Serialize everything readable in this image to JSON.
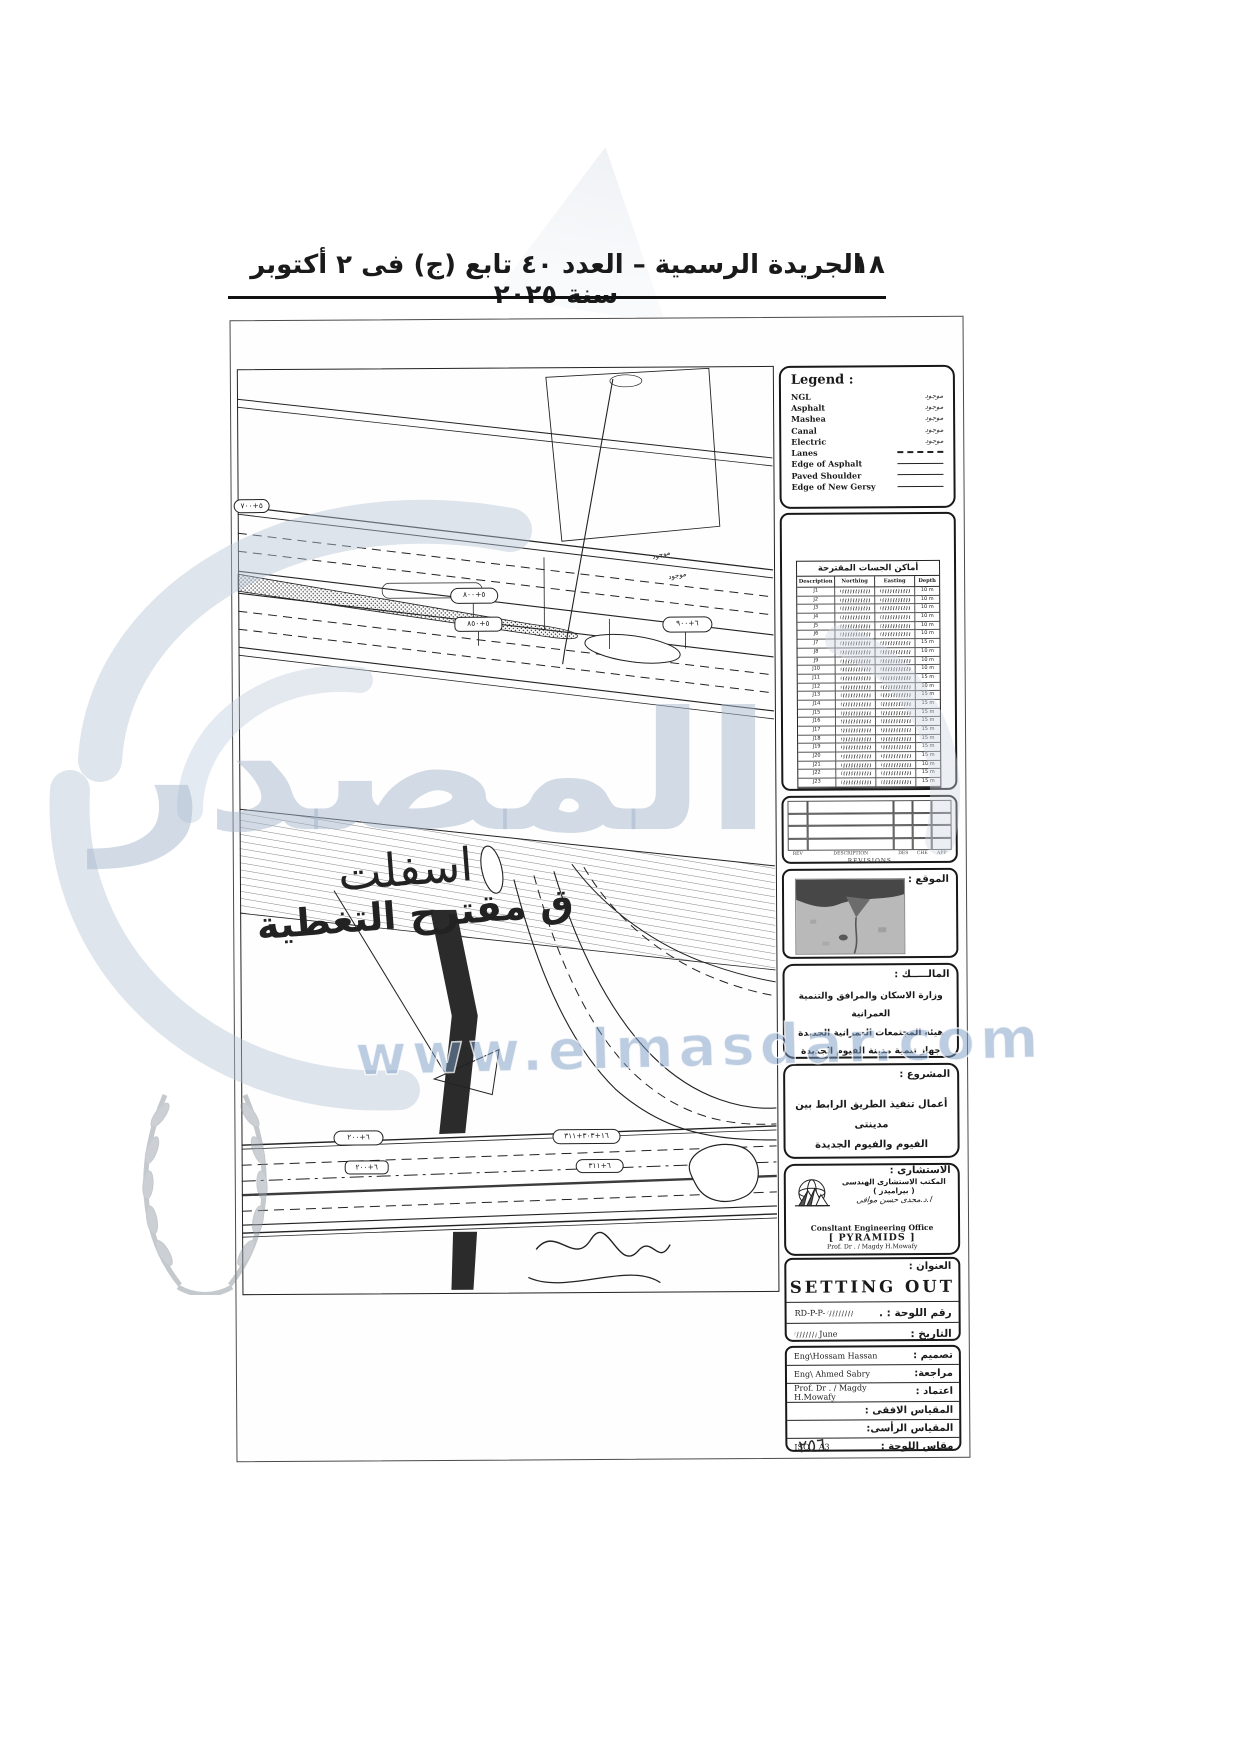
{
  "header": {
    "page_number": "١٨",
    "title": "الجريدة الرسمية – العدد ٤٠ تابع (ج) فى ٢ أكتوبر سنة ٢٠٢٥"
  },
  "legend": {
    "title": "Legend :",
    "items": [
      {
        "label": "NGL",
        "symbol": "scribble",
        "note": "موجود"
      },
      {
        "label": "Asphalt",
        "symbol": "scribble",
        "note": "موجود"
      },
      {
        "label": "Mashea",
        "symbol": "scribble",
        "note": "موجود"
      },
      {
        "label": "Canal",
        "symbol": "scribble",
        "note": "موجود"
      },
      {
        "label": "Electric",
        "symbol": "scribble",
        "note": "موجود"
      },
      {
        "label": "Lanes",
        "symbol": "dashed",
        "note": ""
      },
      {
        "label": "Edge of Asphalt",
        "symbol": "solid",
        "note": ""
      },
      {
        "label": "Paved Shoulder",
        "symbol": "solid",
        "note": ""
      },
      {
        "label": "Edge of New Gersy",
        "symbol": "solid",
        "note": ""
      }
    ]
  },
  "borings_table": {
    "title": "أماكن الجسات المقترحة",
    "columns": [
      "Description",
      "Northing",
      "Easting",
      "Depth"
    ],
    "rows": [
      {
        "n": "J1",
        "d": "10 m"
      },
      {
        "n": "J2",
        "d": "10 m"
      },
      {
        "n": "J3",
        "d": "10 m"
      },
      {
        "n": "J4",
        "d": "10 m"
      },
      {
        "n": "J5",
        "d": "10 m"
      },
      {
        "n": "J6",
        "d": "10 m"
      },
      {
        "n": "J7",
        "d": "15 m"
      },
      {
        "n": "J8",
        "d": "10 m"
      },
      {
        "n": "J9",
        "d": "10 m"
      },
      {
        "n": "J10",
        "d": "10 m"
      },
      {
        "n": "J11",
        "d": "15 m"
      },
      {
        "n": "J12",
        "d": "10 m"
      },
      {
        "n": "J13",
        "d": "15 m"
      },
      {
        "n": "J14",
        "d": "15 m"
      },
      {
        "n": "J15",
        "d": "15 m"
      },
      {
        "n": "J16",
        "d": "15 m"
      },
      {
        "n": "J17",
        "d": "15 m"
      },
      {
        "n": "J18",
        "d": "15 m"
      },
      {
        "n": "J19",
        "d": "15 m"
      },
      {
        "n": "J20",
        "d": "15 m"
      },
      {
        "n": "J21",
        "d": "10 m"
      },
      {
        "n": "J22",
        "d": "15 m"
      },
      {
        "n": "J23",
        "d": "15 m"
      }
    ]
  },
  "revisions": {
    "columns": [
      "REV",
      "DESCRIPTION",
      "DES",
      "CHE",
      "APP"
    ],
    "caption": "REVISIONS"
  },
  "location": {
    "label": "الموقع :"
  },
  "owner": {
    "label": "المالـــــك :",
    "lines": [
      "وزارة الاسكان والمرافق والتنمية العمرانية",
      "هيئة المجتمعات العمرانية الجديدة",
      "جهاز تنمية مدينة الفيوم الجديدة"
    ]
  },
  "project": {
    "label": "المشروع :",
    "lines": [
      "أعمال تنفيذ الطريق الرابط بين مدينتى",
      "الفيوم والفيوم الجديدة"
    ]
  },
  "consultant": {
    "label": "الاستشارى :",
    "office_ar": "المكتب الاستشارى الهندسى",
    "office_ar2": "( بيراميدز )",
    "principal_ar": "ا.د.مجدى حسن موافى",
    "office_en": "Consltant Engineering Office",
    "office_en2": "[ PYRAMIDS ]",
    "principal_en": "Prof. Dr . / Magdy H.Mowafy"
  },
  "title_block": {
    "label": "العنوان :",
    "title": "SETTING  OUT",
    "drawing_no_label": "رقم اللوحة : .",
    "drawing_no_value": "RD-P-P-",
    "date_label": "التاريخ :",
    "date_value": "June"
  },
  "signatures": {
    "rows": [
      {
        "label": "تصميم :",
        "value": "Eng\\Hossam Hassan"
      },
      {
        "label": "مراجعة:",
        "value": "Eng\\ Ahmed Sabry"
      },
      {
        "label": "اعتماد :",
        "value": "Prof. Dr . / Magdy H.Mowafy"
      },
      {
        "label": "المقياس الافقى :",
        "value": ""
      },
      {
        "label": "المقياس الرأسى:",
        "value": ""
      },
      {
        "label": "مقاس اللوحة :",
        "value": "ISO _ A3"
      }
    ]
  },
  "drawing": {
    "stations": [
      "٥+٧٠٠",
      "٥+٨٠٠",
      "٥+٨٥٠",
      "٦+٩٠٠",
      "٦+٢٠٠",
      "٦+٢٠٠",
      "١٦+٣٠٣+٣١١",
      "٦+٣١١"
    ],
    "notes": {
      "asphalt": "اسفلت",
      "covering": "ق مقترح التغطية",
      "existing": "موجود"
    },
    "page_mark": "٢٥٦"
  },
  "watermark": {
    "brand": "المصدر",
    "url": "www.elmasdar.com"
  }
}
